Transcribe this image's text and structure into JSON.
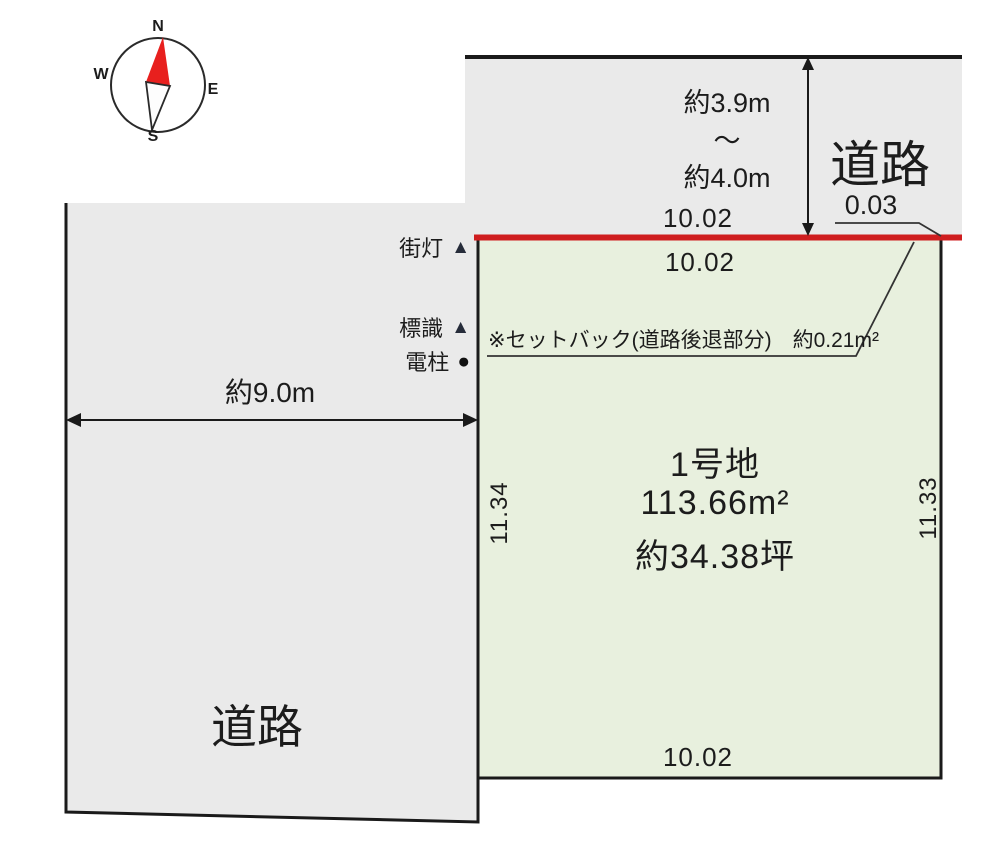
{
  "compass": {
    "north": "N",
    "east": "E",
    "south": "S",
    "west": "W"
  },
  "top_road": {
    "label": "道路",
    "width_min": "約3.9m",
    "range_tilde": "～",
    "width_max": "約4.0m",
    "dim_frontage": "10.02",
    "offset": "0.03"
  },
  "plot": {
    "dim_inner_top": "10.02",
    "name": "1号地",
    "area_m2": "113.66m²",
    "area_tsubo": "約34.38坪",
    "side_left": "11.34",
    "side_right": "11.33",
    "dim_bottom": "10.02",
    "setback_note": "※セットバック(道路後退部分)　約0.21m²"
  },
  "left_road": {
    "label": "道路",
    "width": "約9.0m"
  },
  "legend": {
    "items": [
      {
        "label": "街灯",
        "marker": "▲"
      },
      {
        "label": "標識",
        "marker": "▲"
      },
      {
        "label": "電柱",
        "marker": "●"
      }
    ]
  },
  "colors": {
    "road_fill": "#eaeaea",
    "plot_fill": "#e8f0de",
    "setback_line_red": "#cf1d1f",
    "compass_needle_red": "#e8201e",
    "legend_marker_dark": "#262c3a",
    "line_black": "#1a1a1a"
  }
}
